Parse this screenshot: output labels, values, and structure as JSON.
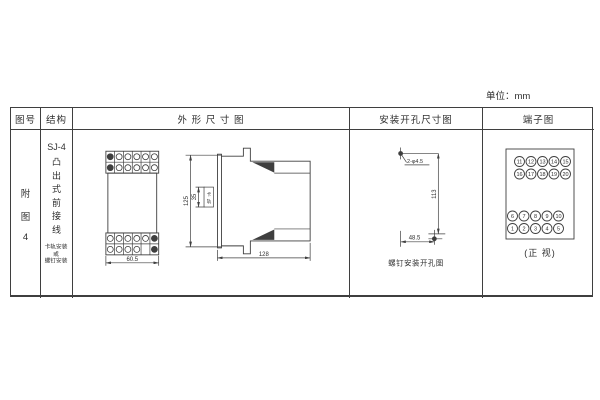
{
  "unit_label": "单位：mm",
  "header": {
    "figure_no": "图号",
    "structure": "结构",
    "outline": "外 形 尺 寸 图",
    "mounting": "安装开孔尺寸图",
    "terminal": "端子图"
  },
  "figure_no": {
    "chars": [
      "附",
      "图",
      "4"
    ]
  },
  "structure": {
    "model": "SJ-4",
    "type_chars": [
      "凸",
      "出",
      "式",
      "前",
      "接",
      "线"
    ],
    "note_lines": [
      "卡轨安装",
      "或",
      "螺钉安装"
    ]
  },
  "outline": {
    "front_width": "60.5",
    "height": "125",
    "rail_height": "35",
    "rail_chars": [
      "卡",
      "轨"
    ],
    "depth": "128"
  },
  "mounting": {
    "holes_label": "2-φ4.5",
    "height": "113",
    "width": "48.5",
    "caption": "螺钉安装开孔图"
  },
  "terminals": {
    "top": [
      [
        "11",
        "12",
        "13",
        "14",
        "15"
      ],
      [
        "16",
        "17",
        "18",
        "19",
        "20"
      ]
    ],
    "bottom": [
      [
        "6",
        "7",
        "8",
        "9",
        "10"
      ],
      [
        "1",
        "2",
        "3",
        "4",
        "5"
      ]
    ],
    "caption": "(正 视)"
  },
  "colors": {
    "line": "#3f3f3f",
    "text": "#2f2f2f",
    "background": "#ffffff"
  }
}
